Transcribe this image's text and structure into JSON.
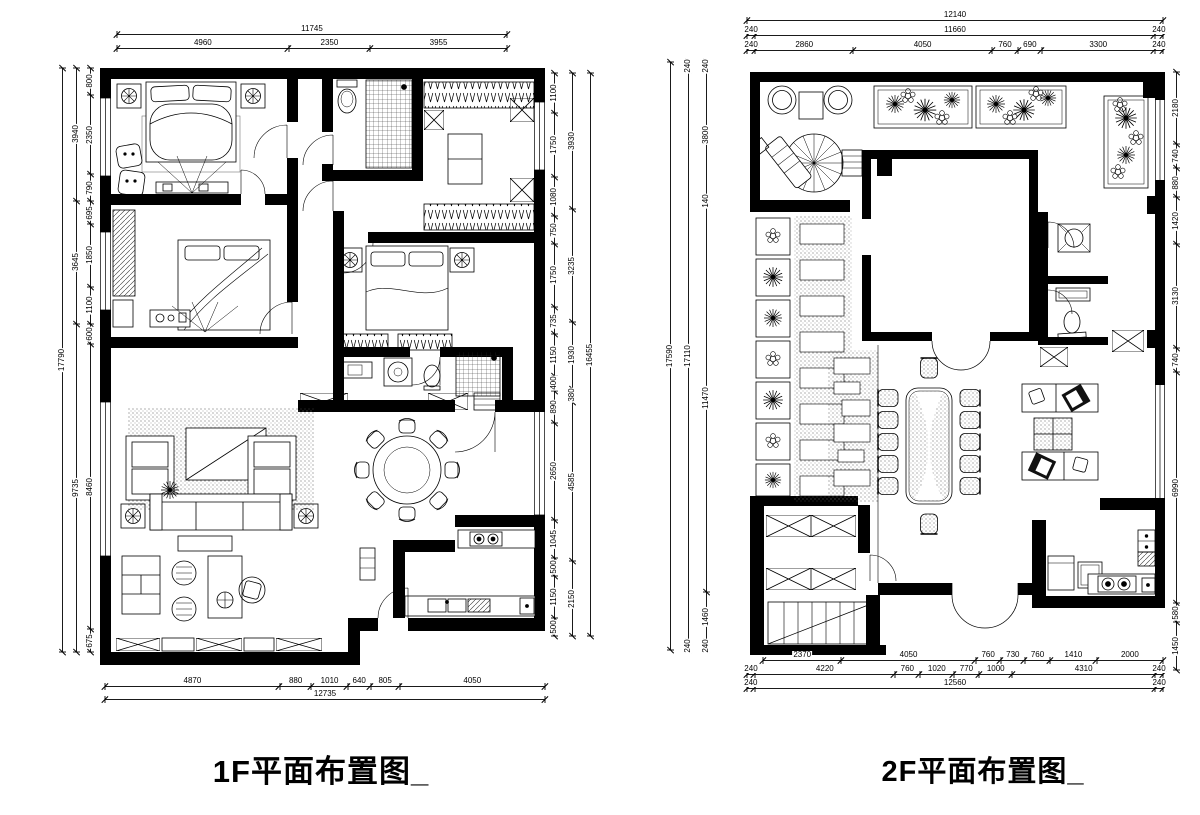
{
  "colors": {
    "ink": "#000000",
    "background": "#ffffff"
  },
  "f1": {
    "title": "1F平面布置图_",
    "dims": {
      "top": {
        "overall": [
          "11745"
        ],
        "segments": [
          "4960",
          "2350",
          "3955"
        ]
      },
      "left": {
        "outer": [
          "17790"
        ],
        "mid": [
          "3940",
          "3645",
          "9735"
        ],
        "inner": [
          "800",
          "2350",
          "790",
          "695",
          "1850",
          "1100",
          "600",
          "8460",
          "675"
        ]
      },
      "right": {
        "inner": [
          "1100",
          "1750",
          "1080",
          "750",
          "1750",
          "735",
          "1150",
          "400",
          "890",
          "2650",
          "1045",
          "500",
          "1150",
          "500"
        ],
        "mid": [
          "3930",
          "3235",
          "1930",
          "380",
          "4585",
          "2150"
        ],
        "outer": [
          "16455"
        ]
      },
      "bottom": {
        "segments": [
          "4870",
          "880",
          "1010",
          "640",
          "805",
          "4050"
        ],
        "overall": [
          "12735"
        ]
      }
    }
  },
  "f2": {
    "title": "2F平面布置图_",
    "dims": {
      "top": {
        "overall": [
          "12140"
        ],
        "mid": [
          "240",
          "11660",
          "240"
        ],
        "segments": [
          "240",
          "2860",
          "4050",
          "760",
          "690",
          "3300",
          "240"
        ]
      },
      "left": {
        "outer": [
          "17590"
        ],
        "mid": [
          "240",
          "17110",
          "240"
        ],
        "inner": [
          "240",
          "3800",
          "140",
          "11470",
          "1460",
          "240"
        ]
      },
      "right": {
        "segments": [
          "2180",
          "740",
          "880",
          "1420",
          "3130",
          "740",
          "6990",
          "580",
          "1450"
        ]
      },
      "bottom": {
        "segments": [
          "2370",
          "4050",
          "760",
          "730",
          "760",
          "1410",
          "2000"
        ],
        "mid": [
          "240",
          "4220",
          "760",
          "1020",
          "770",
          "1000",
          "4310",
          "240"
        ],
        "overall": [
          "240",
          "12560",
          "240"
        ]
      }
    }
  }
}
